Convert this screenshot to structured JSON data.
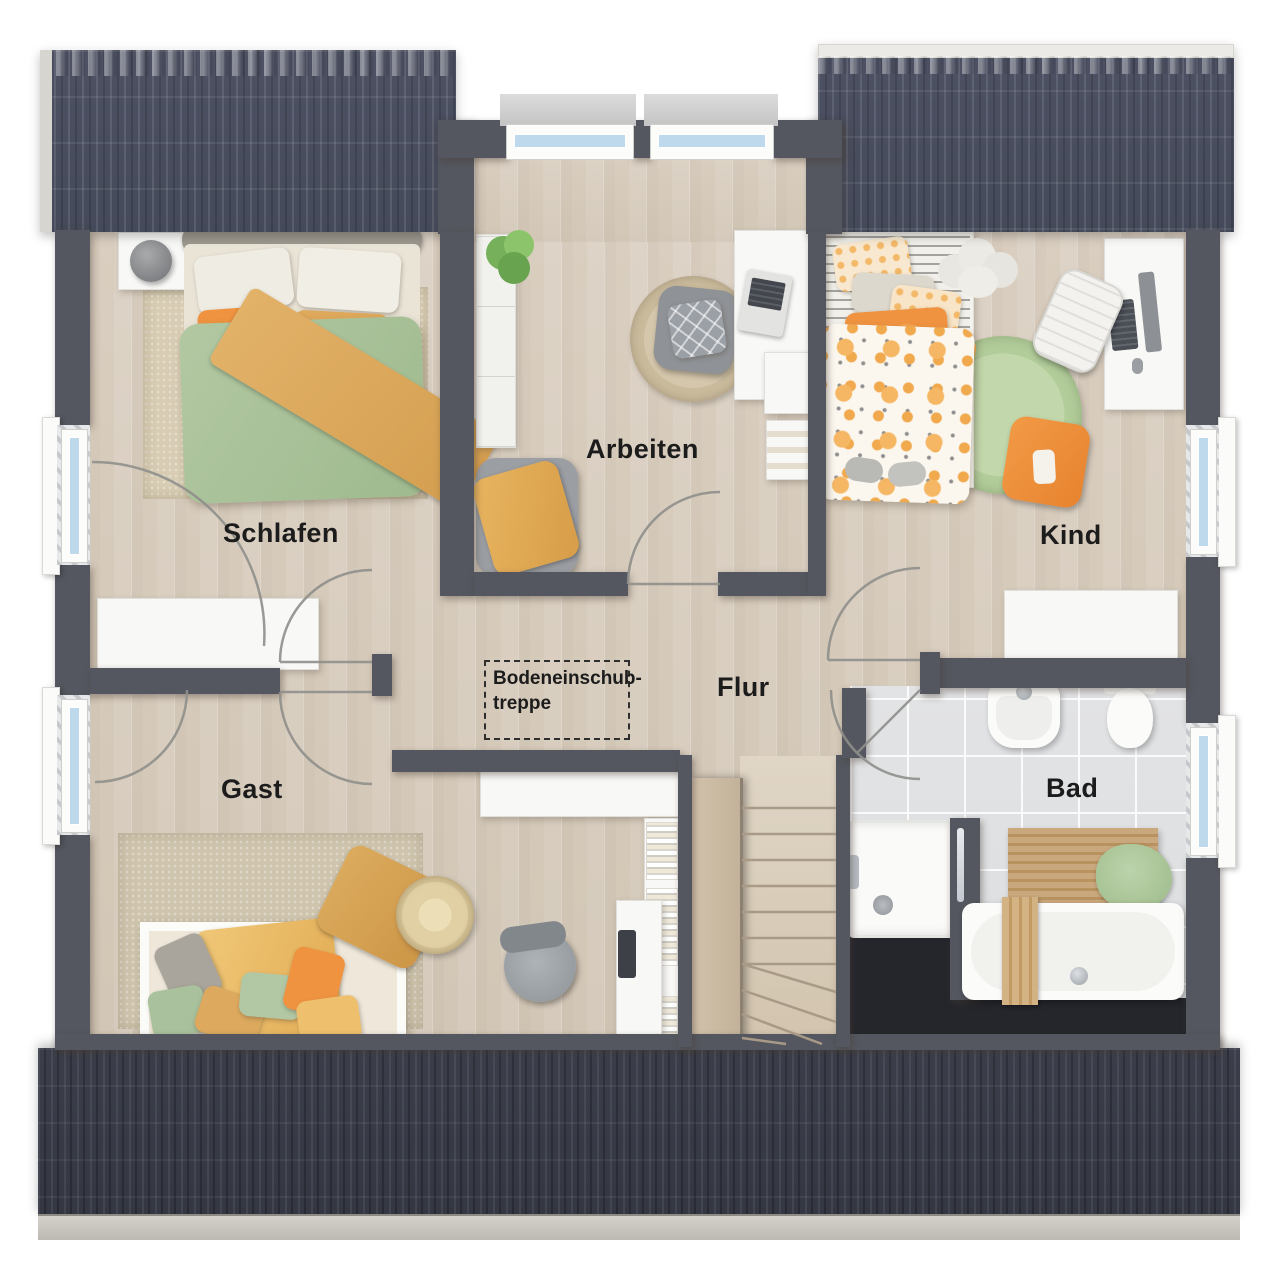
{
  "floorplan": {
    "title": "Obergeschoss Grundriss",
    "rooms": [
      {
        "id": "schlafen",
        "label": "Schlafen"
      },
      {
        "id": "arbeiten",
        "label": "Arbeiten"
      },
      {
        "id": "kind",
        "label": "Kind"
      },
      {
        "id": "flur",
        "label": "Flur"
      },
      {
        "id": "gast",
        "label": "Gast"
      },
      {
        "id": "bad",
        "label": "Bad"
      }
    ],
    "annotations": [
      {
        "id": "bodeneinschubtreppe",
        "line1": "Bodeneinschub-",
        "line2": "treppe"
      }
    ]
  },
  "palette": {
    "wall": "#54575f",
    "roof": "#4a4e60",
    "roof_bottom": "#383b46",
    "wood_floor": "#d8cec0",
    "tile_floor": "#dfe1e3",
    "dead_space": "#24262c",
    "window_glass": "#bed8ec",
    "duvet_green": "#a9c19a",
    "accent_orange": "#ef9340",
    "accent_ochre": "#dcab64",
    "rug_green": "#b7cf9f"
  }
}
